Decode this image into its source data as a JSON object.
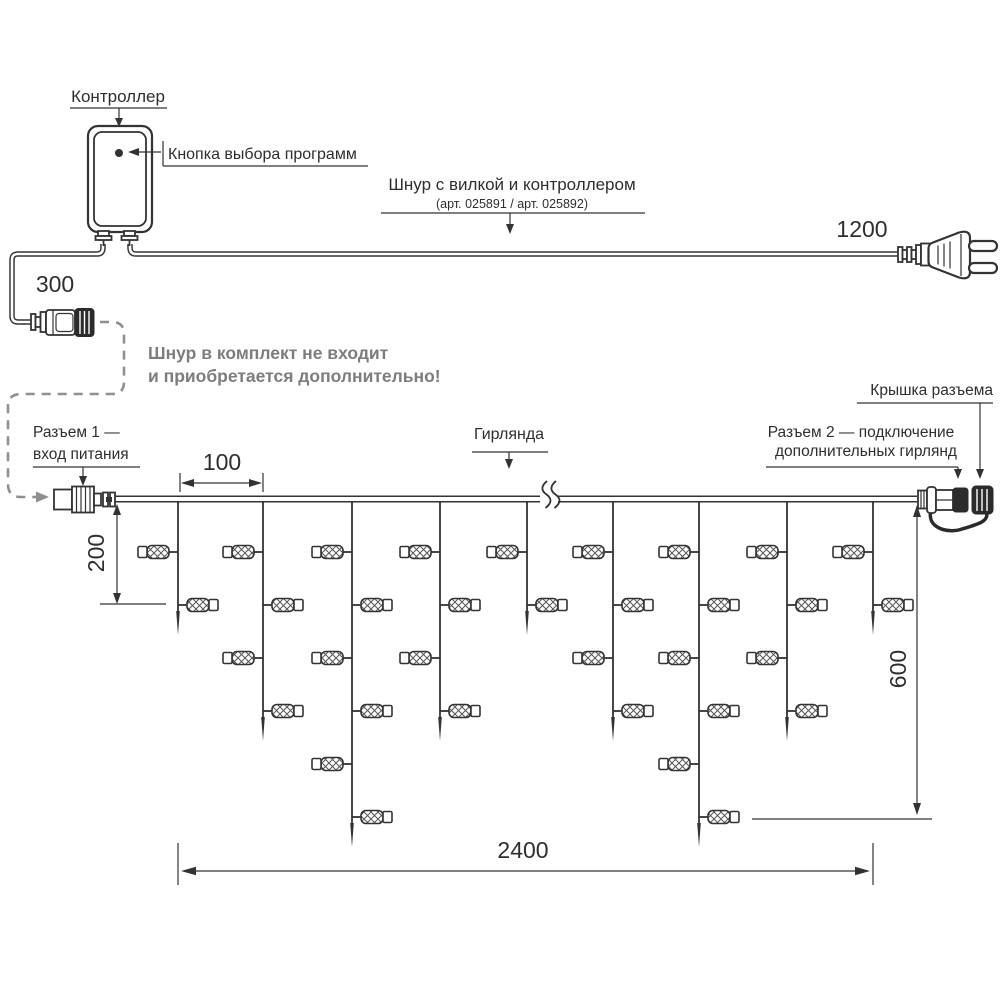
{
  "diagram": {
    "labels": {
      "controller": "Контроллер",
      "program_button": "Кнопка выбора программ",
      "cord_with_plug": "Шнур с вилкой и контроллером",
      "cord_articles": "(арт. 025891 / арт. 025892)",
      "note_line1": "Шнур в комплект не входит",
      "note_line2": "и приобретается дополнительно!",
      "connector1_line1": "Разъем 1 —",
      "connector1_line2": "вход питания",
      "garland": "Гирлянда",
      "connector_cover": "Крышка разъема",
      "connector2_line1": "Разъем 2 — подключение",
      "connector2_line2": "дополнительных гирлянд"
    },
    "dimensions": {
      "cord_left": "300",
      "cord_right": "1200",
      "drop_spacing": "100",
      "drop_min_length": "200",
      "drop_max_length": "600",
      "garland_length": "2400"
    },
    "colors": {
      "line": "#333333",
      "note_text": "#7d7d7d",
      "dashed_cord": "#8f8f8f"
    },
    "garland": {
      "wire_y": 499,
      "lamp_row_start_y": 552,
      "lamp_row_spacing": 53,
      "drops": [
        {
          "x": 178,
          "lamps": 2
        },
        {
          "x": 263,
          "lamps": 4
        },
        {
          "x": 352,
          "lamps": 6
        },
        {
          "x": 440,
          "lamps": 4
        },
        {
          "x": 527,
          "lamps": 2
        },
        {
          "x": 613,
          "lamps": 4
        },
        {
          "x": 699,
          "lamps": 6
        },
        {
          "x": 787,
          "lamps": 4
        },
        {
          "x": 873,
          "lamps": 2
        }
      ]
    }
  }
}
